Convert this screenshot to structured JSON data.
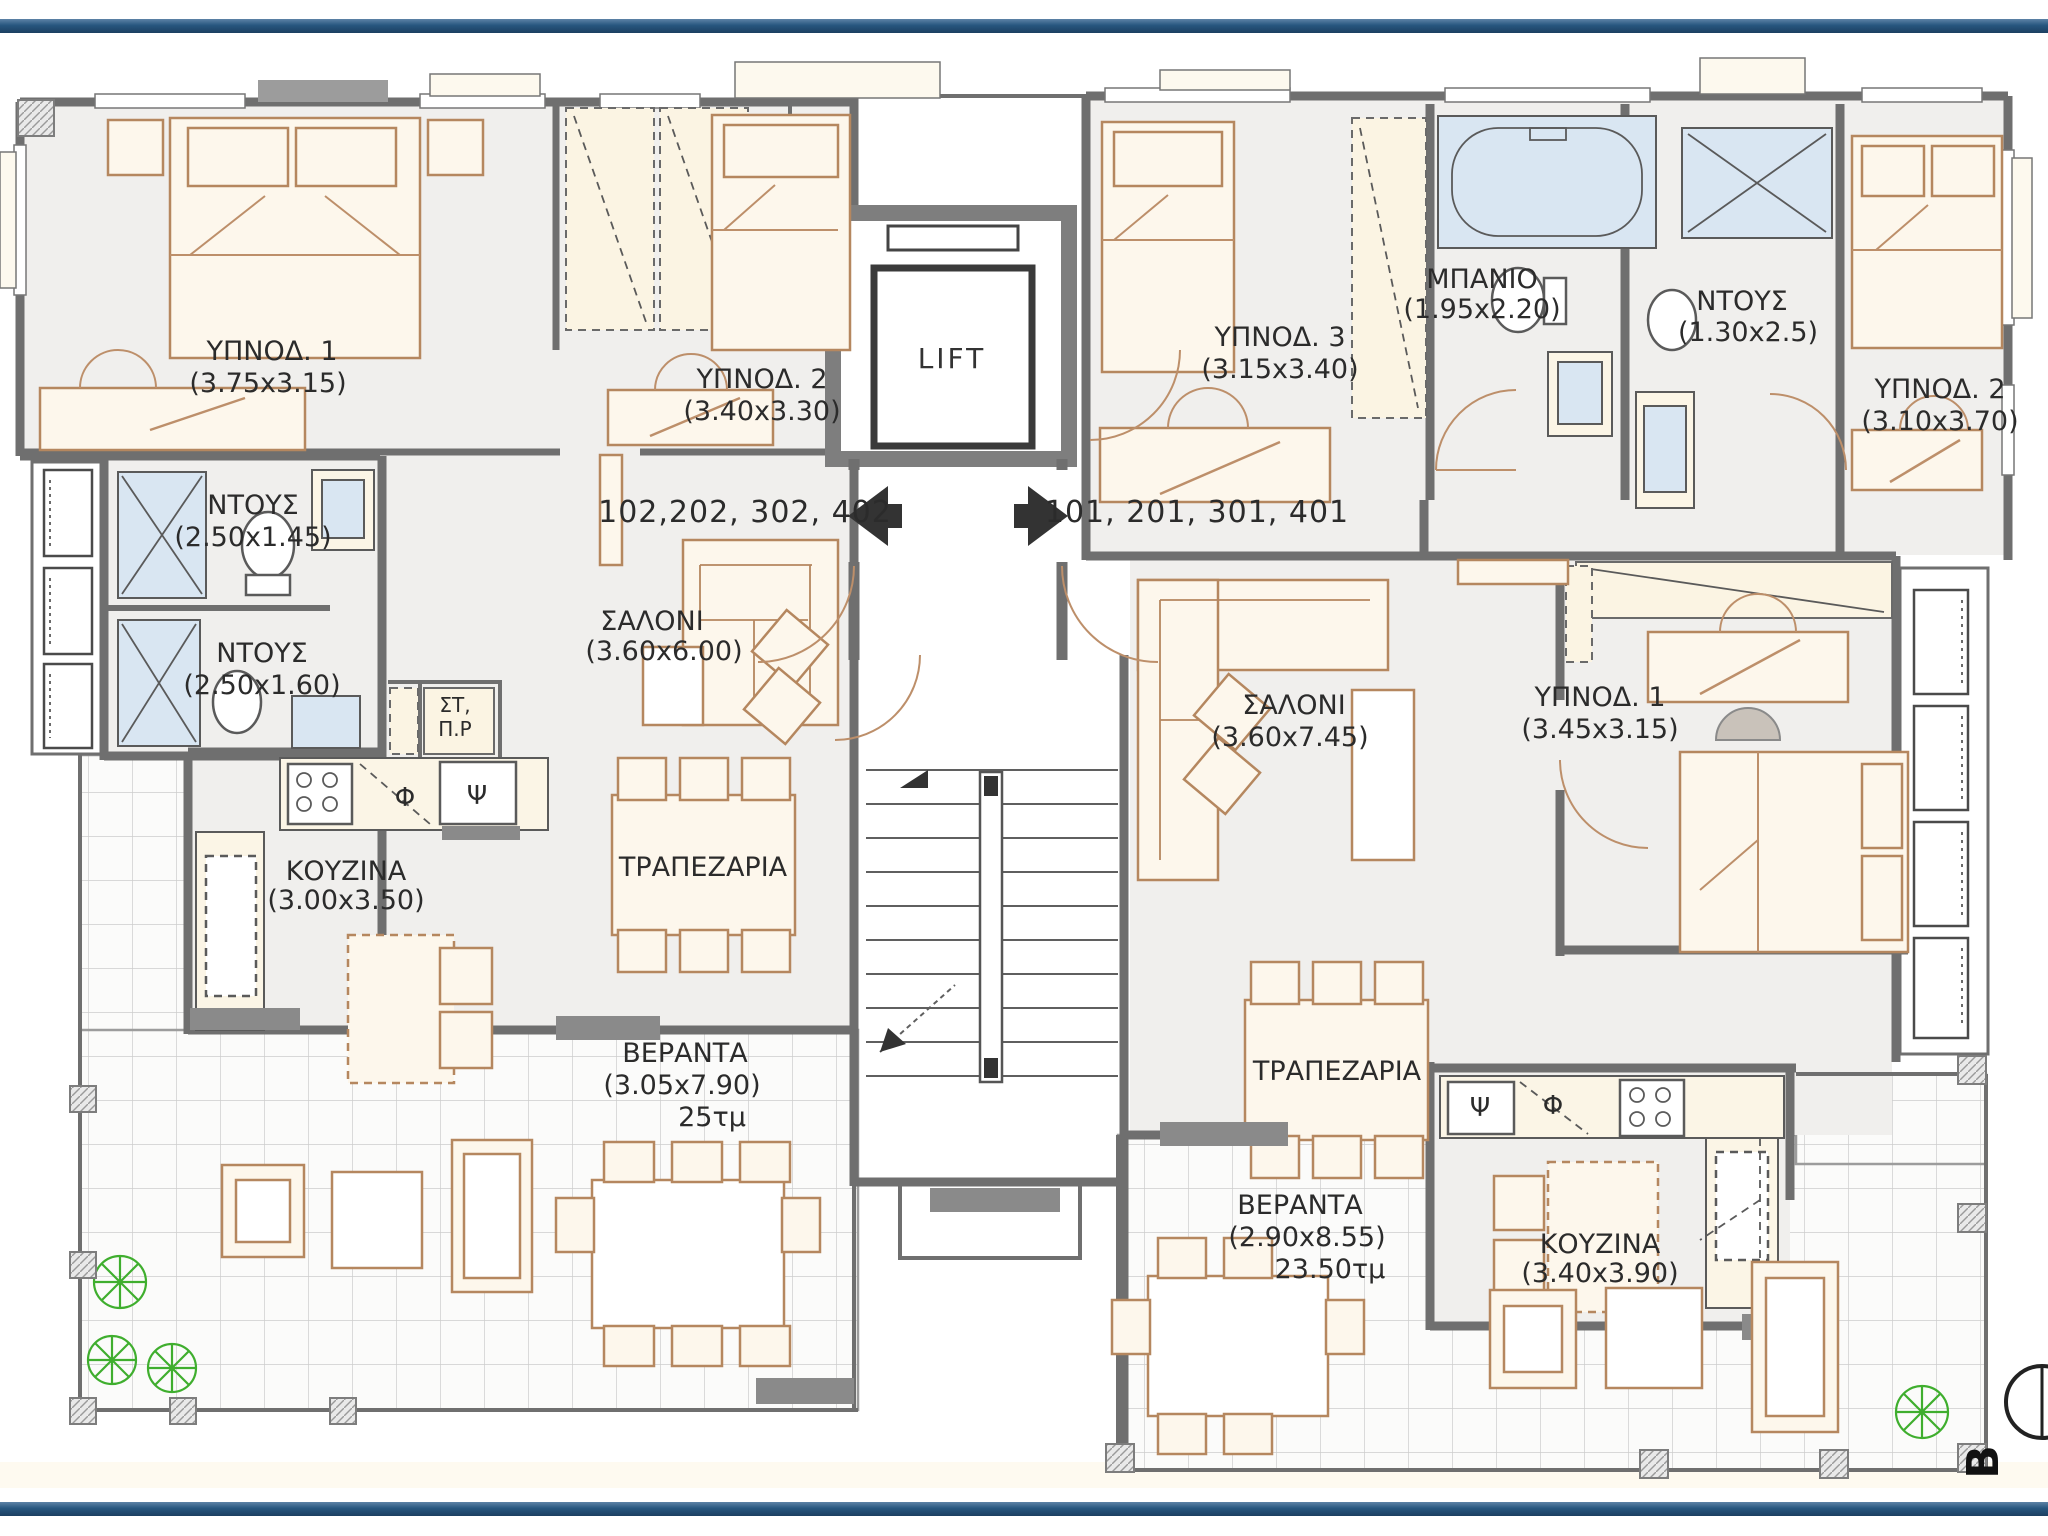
{
  "page": {
    "background": "#ffffff",
    "bar_color": "#27567f"
  },
  "plan": {
    "lift_label": "LIFT",
    "compass_letter": "B",
    "left_unit_numbers": "102,202, 302, 402",
    "right_unit_numbers": "101, 201, 301, 401",
    "left_apartment": {
      "bedroom1": {
        "name": "ΥΠΝΟΔ. 1",
        "dims": "(3.75x3.15)"
      },
      "bedroom2": {
        "name": "ΥΠΝΟΔ. 2",
        "dims": "(3.40x3.30)"
      },
      "shower1": {
        "name": "ΝΤΟΥΣ",
        "dims": "(2.50x1.45)"
      },
      "shower2": {
        "name": "ΝΤΟΥΣ",
        "dims": "(2.50x1.60)"
      },
      "living": {
        "name": "ΣΑΛΟΝΙ",
        "dims": "(3.60x6.00)"
      },
      "kitchen": {
        "name": "ΚΟΥΖΙΝΑ",
        "dims": "(3.00x3.50)"
      },
      "dining": {
        "name": "ΤΡΑΠΕΖΑΡΙΑ"
      },
      "veranda": {
        "name": "ΒΕΡΑΝΤΑ",
        "dims": "(3.05x7.90)",
        "area": "25τμ"
      },
      "laundry": {
        "line1": "ΣΤ,",
        "line2": "Π.Ρ"
      },
      "washer_symbol": "Φ",
      "sink_symbol": "Ψ"
    },
    "right_apartment": {
      "bedroom3": {
        "name": "ΥΠΝΟΔ. 3",
        "dims": "(3.15x3.40)"
      },
      "bathroom": {
        "name": "ΜΠΑΝΙΟ",
        "dims": "(1.95x2.20)"
      },
      "shower": {
        "name": "ΝΤΟΥΣ",
        "dims": "(1.30x2.5)"
      },
      "bedroom2": {
        "name": "ΥΠΝΟΔ. 2",
        "dims": "(3.10x3.70)"
      },
      "bedroom1": {
        "name": "ΥΠΝΟΔ. 1",
        "dims": "(3.45x3.15)"
      },
      "living": {
        "name": "ΣΑΛΟΝΙ",
        "dims": "(3.60x7.45)"
      },
      "dining": {
        "name": "ΤΡΑΠΕΖΑΡΙΑ"
      },
      "kitchen": {
        "name": "ΚΟΥΖΙΝΑ",
        "dims": "(3.40x3.90)"
      },
      "veranda": {
        "name": "ΒΕΡΑΝΤΑ",
        "dims": "(2.90x8.55)",
        "area": "23.50τμ"
      },
      "washer_symbol": "Φ",
      "sink_symbol": "Ψ"
    }
  }
}
